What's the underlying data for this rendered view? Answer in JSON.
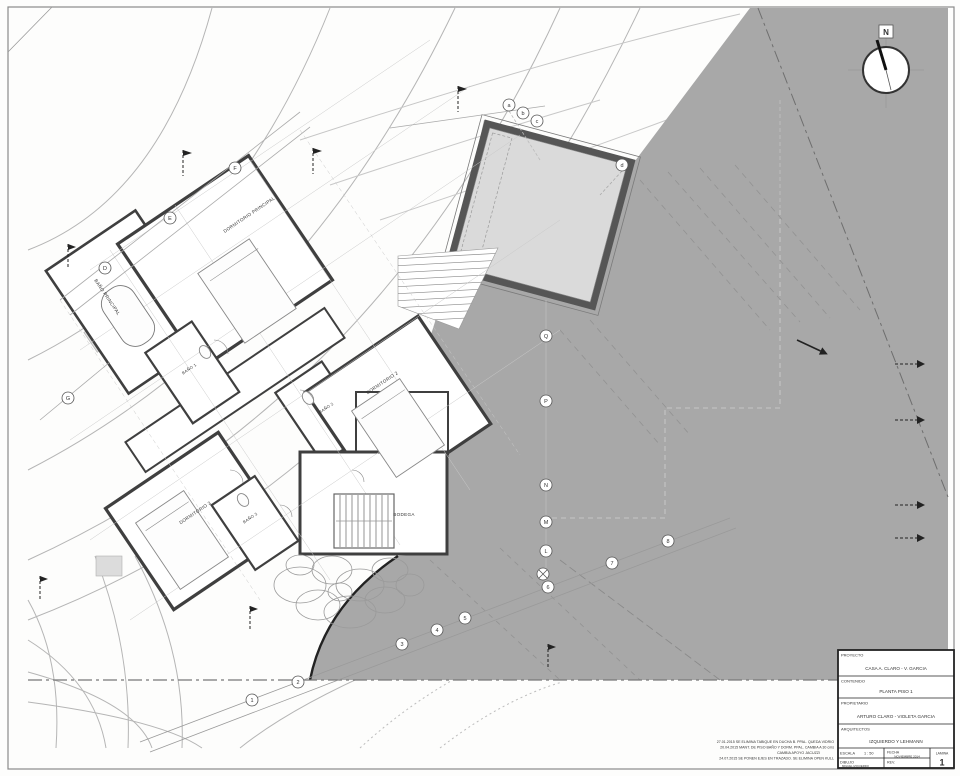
{
  "sheet": {
    "north_label": "N"
  },
  "title_block": {
    "proyecto_label": "PROYECTO",
    "proyecto": "CASA  A. CLARO - V. GARCIA",
    "contenido_label": "CONTENIDO",
    "contenido": "PLANTA PISO 1",
    "propietario_label": "PROPIETARIO",
    "propietario": "ARTURO CLARO - VIOLETA GARCIA",
    "arquitectos_label": "ARQUITECTOS",
    "arquitectos": "IZQUIERDO Y LEHMANN",
    "escala_label": "ESCALA",
    "escala": "1 : 50",
    "fecha_label": "FECHA",
    "fecha": "NOVIEMBRE 2014",
    "lamina_label": "LAMINA",
    "lamina": "1",
    "dibujo_label": "DIBUJO",
    "dibujo": "MIGUEL IZQUIERDO",
    "rev_label": "REV."
  },
  "rooms": {
    "dorm_ppal": "DORMITORIO PRINCIPAL",
    "bano_ppal": "BAÑO PRINCIPAL",
    "bano1": "BAÑO 1",
    "bano2": "BAÑO 2",
    "dorm2": "DORMITORIO 2",
    "dorm3": "DORMITORIO 3",
    "bano3": "BAÑO 3",
    "bodega": "BODEGA"
  },
  "grid": {
    "pool_letters": [
      "a",
      "b",
      "c",
      "d"
    ],
    "right_letters": [
      "Q",
      "P",
      "N",
      "M",
      "L"
    ],
    "bottom_numbers": [
      "1",
      "2",
      "3",
      "4",
      "5",
      "6",
      "7",
      "8"
    ],
    "upper_left_letters": [
      "D",
      "E",
      "F",
      "G"
    ]
  },
  "revision_notes": [
    "27.01.2015  SE ELIMINA TABIQUE EN DUCHA B. PPAL. QUEDA VIDRIO",
    "20.04.2015  MANT. DE PISO BAÑO Y DORM. PPAL. CAMBIA A 30 cms",
    "CAMBIA APOYO JACUZZI",
    "24.07.2015  SE PONEN EJES EN TRAZADO. SE ELIMINA OPEN KULL"
  ],
  "colors": {
    "terrain": "#a8a8a8",
    "pool_water": "#dadada",
    "wall": "#3f3f3f",
    "contour": "#b5b5b5"
  }
}
